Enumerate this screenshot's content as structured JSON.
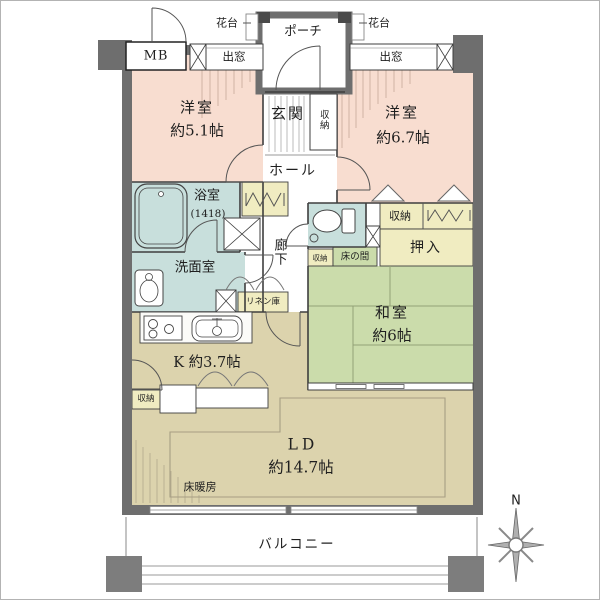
{
  "colors": {
    "wall": "#6e6e6e",
    "western_room": "#f8ddd0",
    "japanese_room": "#cbdcab",
    "wet_area": "#c8dfdc",
    "closet": "#f0ecc1",
    "living": "#dcd3ad"
  },
  "exterior": {
    "meter_box": "MB",
    "bay_window_left": "出窓",
    "bay_window_right": "出窓",
    "flower_stand_left": "花台",
    "flower_stand_right": "花台",
    "porch": "ポーチ",
    "balcony": "バルコニー",
    "compass_north": "N"
  },
  "rooms": {
    "western1": {
      "name": "洋室",
      "size": "約5.1帖"
    },
    "western2": {
      "name": "洋室",
      "size": "約6.7帖"
    },
    "japanese": {
      "name": "和室",
      "size": "約6帖"
    },
    "kitchen": {
      "label": "K 約3.7帖"
    },
    "living_dining": {
      "name": "LD",
      "size": "約14.7帖",
      "floor_heating": "床暖房"
    },
    "bathroom": {
      "name": "浴室",
      "size": "(1418)"
    },
    "washroom": {
      "name": "洗面室"
    },
    "entrance": {
      "name": "玄関"
    },
    "hall": {
      "name": "ホール"
    },
    "corridor": {
      "name": "廊下"
    }
  },
  "storage": {
    "entrance_storage": "収納",
    "hallway_storage": "収納",
    "bedroom_storage": "収納",
    "kitchen_storage": "収納",
    "linen_closet": "リネン庫",
    "oshiire": "押入",
    "tokonoma": "床の間"
  }
}
